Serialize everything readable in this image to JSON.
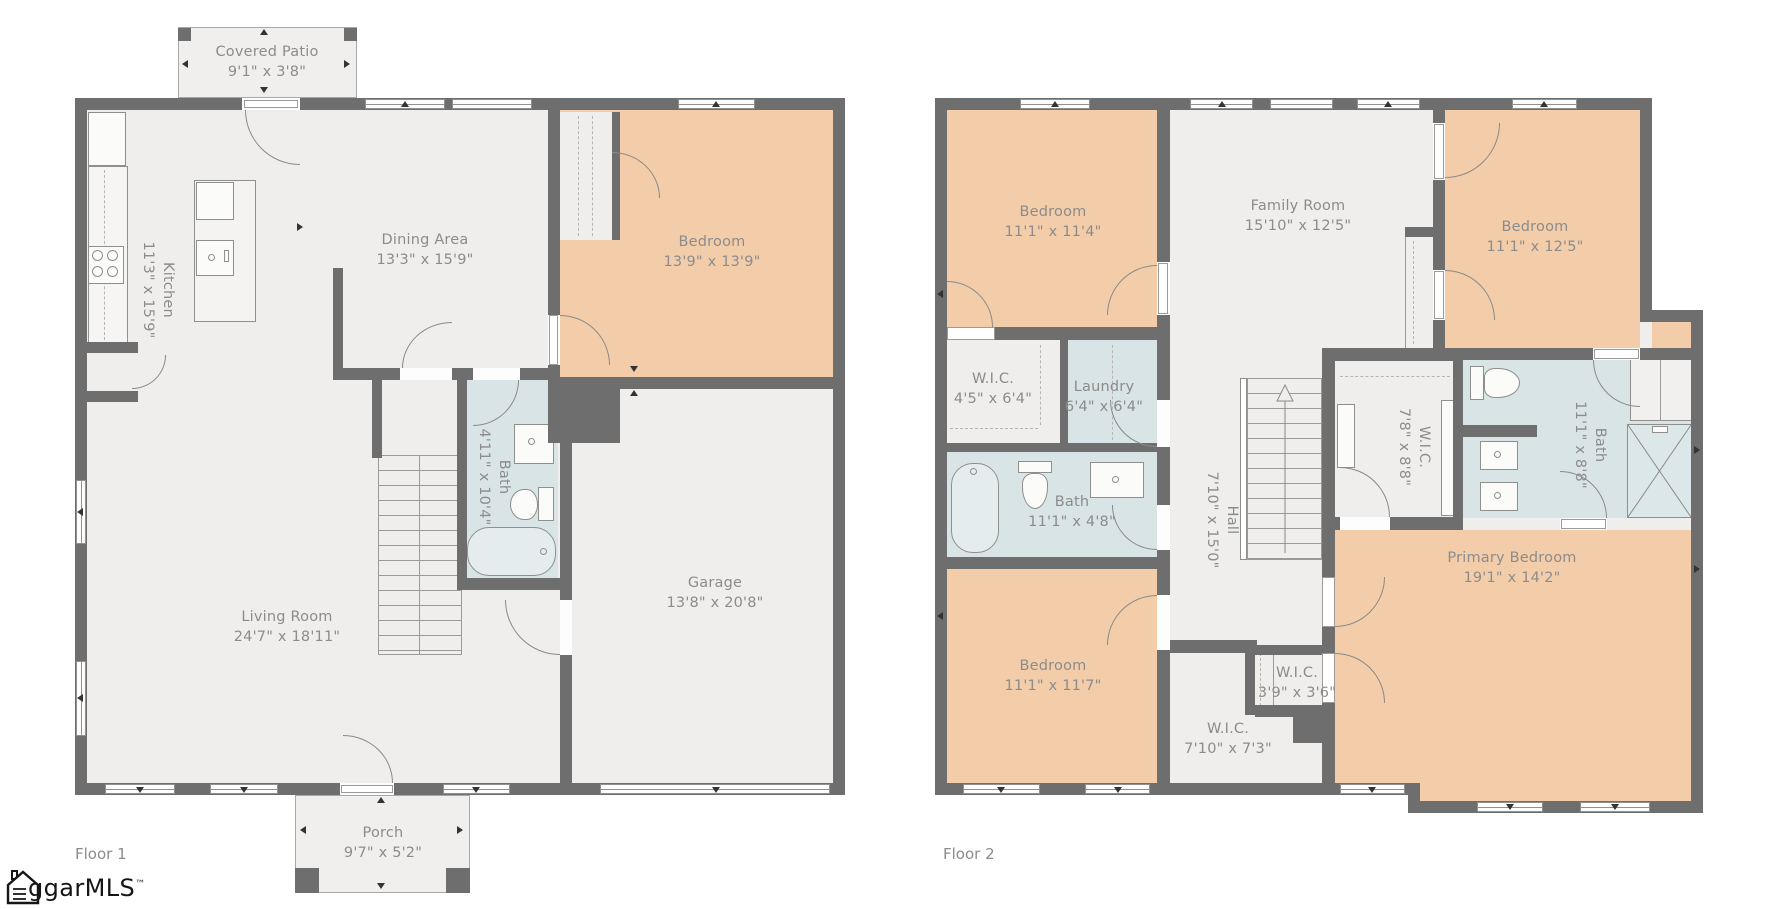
{
  "colors": {
    "wall": "#6e6e6e",
    "floor": "#efeeec",
    "bedroom": "#f3cda9",
    "bath": "#d8e4e6",
    "outdoor": "#f0efee",
    "label": "#8c8c8c"
  },
  "floor1": {
    "label": "Floor 1",
    "rooms": [
      {
        "name": "Covered Patio",
        "dims": "9'1\" x 3'8\""
      },
      {
        "name": "Kitchen",
        "dims": "11'3\" x 15'9\""
      },
      {
        "name": "Dining Area",
        "dims": "13'3\" x 15'9\""
      },
      {
        "name": "Bedroom",
        "dims": "13'9\" x 13'9\""
      },
      {
        "name": "Bath",
        "dims": "4'11\" x 10'4\""
      },
      {
        "name": "Living Room",
        "dims": "24'7\" x 18'11\""
      },
      {
        "name": "Garage",
        "dims": "13'8\" x 20'8\""
      },
      {
        "name": "Porch",
        "dims": "9'7\" x 5'2\""
      }
    ]
  },
  "floor2": {
    "label": "Floor 2",
    "rooms": [
      {
        "name": "Bedroom",
        "dims": "11'1\" x 11'4\""
      },
      {
        "name": "Family Room",
        "dims": "15'10\" x 12'5\""
      },
      {
        "name": "Bedroom",
        "dims": "11'1\" x 12'5\""
      },
      {
        "name": "W.I.C.",
        "dims": "4'5\" x 6'4\""
      },
      {
        "name": "Laundry",
        "dims": "6'4\" x 6'4\""
      },
      {
        "name": "Bath",
        "dims": "11'1\" x 4'8\""
      },
      {
        "name": "Hall",
        "dims": "7'10\" x 15'0\""
      },
      {
        "name": "W.I.C.",
        "dims": "7'8\" x 8'8\""
      },
      {
        "name": "Bath",
        "dims": "11'1\" x 8'8\""
      },
      {
        "name": "Bedroom",
        "dims": "11'1\" x 11'7\""
      },
      {
        "name": "W.I.C.",
        "dims": "3'9\" x 3'6\""
      },
      {
        "name": "W.I.C.",
        "dims": "7'10\" x 7'3\""
      },
      {
        "name": "Primary Bedroom",
        "dims": "19'1\" x 14'2\""
      }
    ]
  },
  "logo": {
    "text": "ggarMLS",
    "tm": "™"
  }
}
